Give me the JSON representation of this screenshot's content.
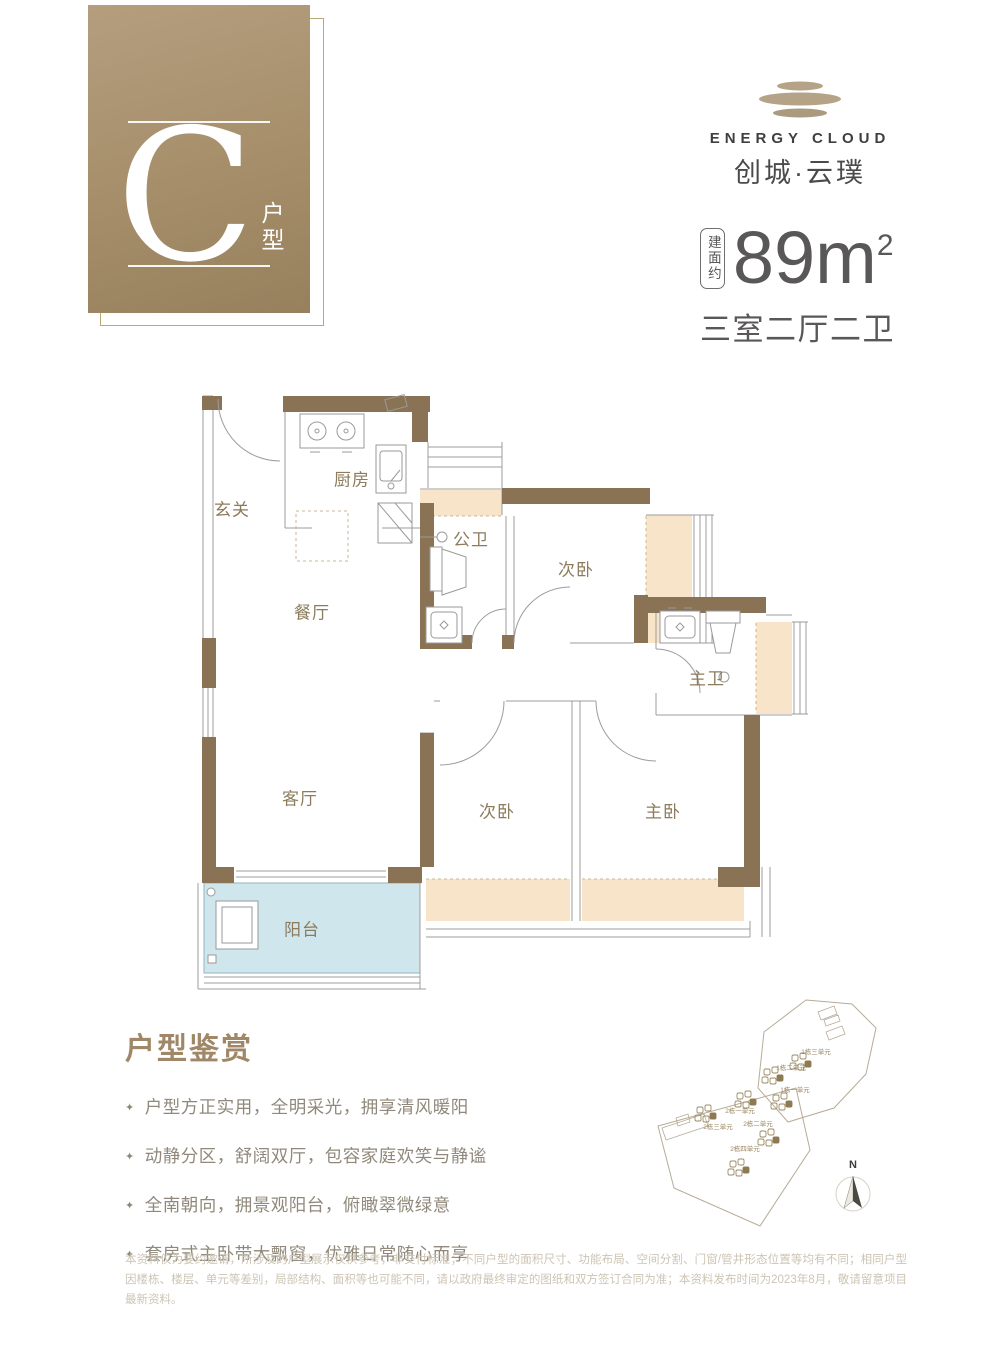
{
  "badge": {
    "letter": "C",
    "suffix": "户型"
  },
  "logo": {
    "name_en": "ENERGY CLOUD",
    "name_cn": "创城·云璞"
  },
  "area": {
    "label_vertical": "建面约",
    "value": "89",
    "unit": "m",
    "exponent": "2",
    "layout": "三室二厅二卫"
  },
  "floorplan": {
    "rooms": {
      "entry": "玄关",
      "kitchen": "厨房",
      "guest_bath": "公卫",
      "bedroom2": "次卧",
      "dining": "餐厅",
      "master_bath": "主卫",
      "living": "客厅",
      "bedroom3": "次卧",
      "master_bedroom": "主卧",
      "balcony": "阳台"
    }
  },
  "appreciation": {
    "title": "户型鉴赏",
    "bullet_marker": "✦",
    "bullets": [
      "户型方正实用，全明采光，拥享清风暖阳",
      "动静分区，舒阔双厅，包容家庭欢笑与静谧",
      "全南朝向，拥景观阳台，俯瞰翠微绿意",
      "套房式主卧带大飘窗，优雅日常随心而享"
    ]
  },
  "siteplan": {
    "units": [
      "1栋三单元",
      "1栋二单元",
      "1栋一单元",
      "2栋一单元",
      "2栋三单元",
      "2栋二单元",
      "2栋四单元"
    ],
    "compass_label": "N"
  },
  "disclaimer": "本资料仅为要约邀请，所涉及的户型展示仅供参考，非交付标准；不同户型的面积尺寸、功能布局、空间分割、门窗/管井形态位置等均有不同；相同户型因楼栋、楼层、单元等差别，局部结构、面积等也可能不同，请以政府最终审定的图纸和双方签订合同为准；本资料发布时间为2023年8月，敬请留意项目最新资料。",
  "colors": {
    "wall": "#8a7355",
    "bay_window": "#f8e4c9",
    "balcony": "#d0e6ed",
    "accent": "#a08767",
    "dark_text": "#595757"
  }
}
